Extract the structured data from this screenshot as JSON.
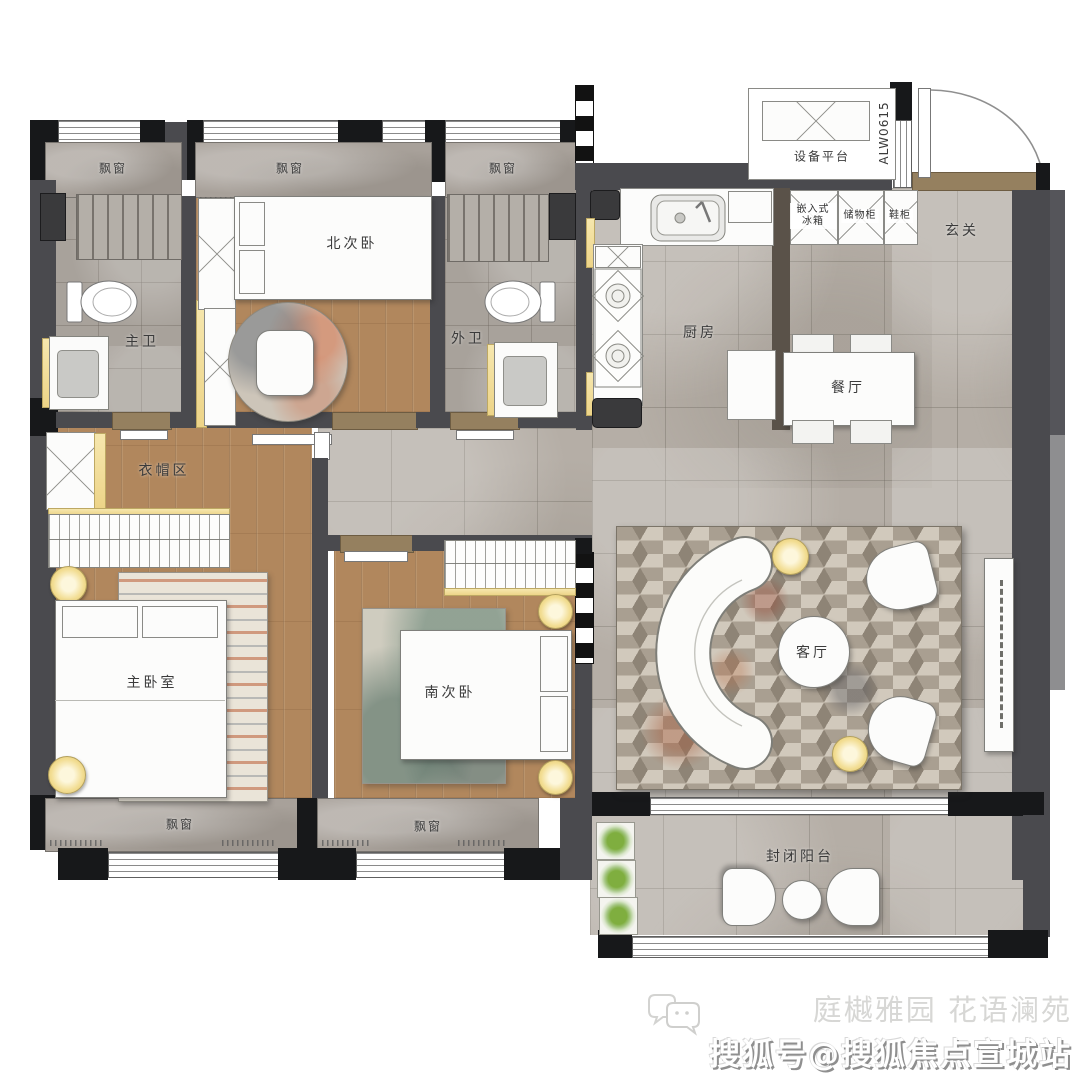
{
  "plan": {
    "rooms": {
      "north_bedroom": "北次卧",
      "master_bath": "主卫",
      "guest_bath": "外卫",
      "kitchen": "厨房",
      "foyer": "玄关",
      "dining": "餐厅",
      "equipment_platform": "设备平台",
      "cloakroom": "衣帽区",
      "master_bedroom": "主卧室",
      "south_bedroom": "南次卧",
      "living_room": "客厅",
      "balcony": "封闭阳台"
    },
    "features": {
      "bay_window": "飘窗",
      "window_code": "ALW0615",
      "built_in_fridge": "嵌入式冰箱",
      "storage_cabinet": "储物柜",
      "shoe_cabinet": "鞋柜"
    }
  },
  "watermark": {
    "project_names": "庭樾雅园 花语澜苑",
    "account": "搜狐号@搜狐焦点宣城站"
  },
  "colors": {
    "wall": "#4a4a4e",
    "column": "#17181a",
    "tile_floor": "#b5aea6",
    "wood_floor": "#b1875d",
    "accent_yellow": "#f2dd92",
    "plant_green": "#7fae3f"
  }
}
